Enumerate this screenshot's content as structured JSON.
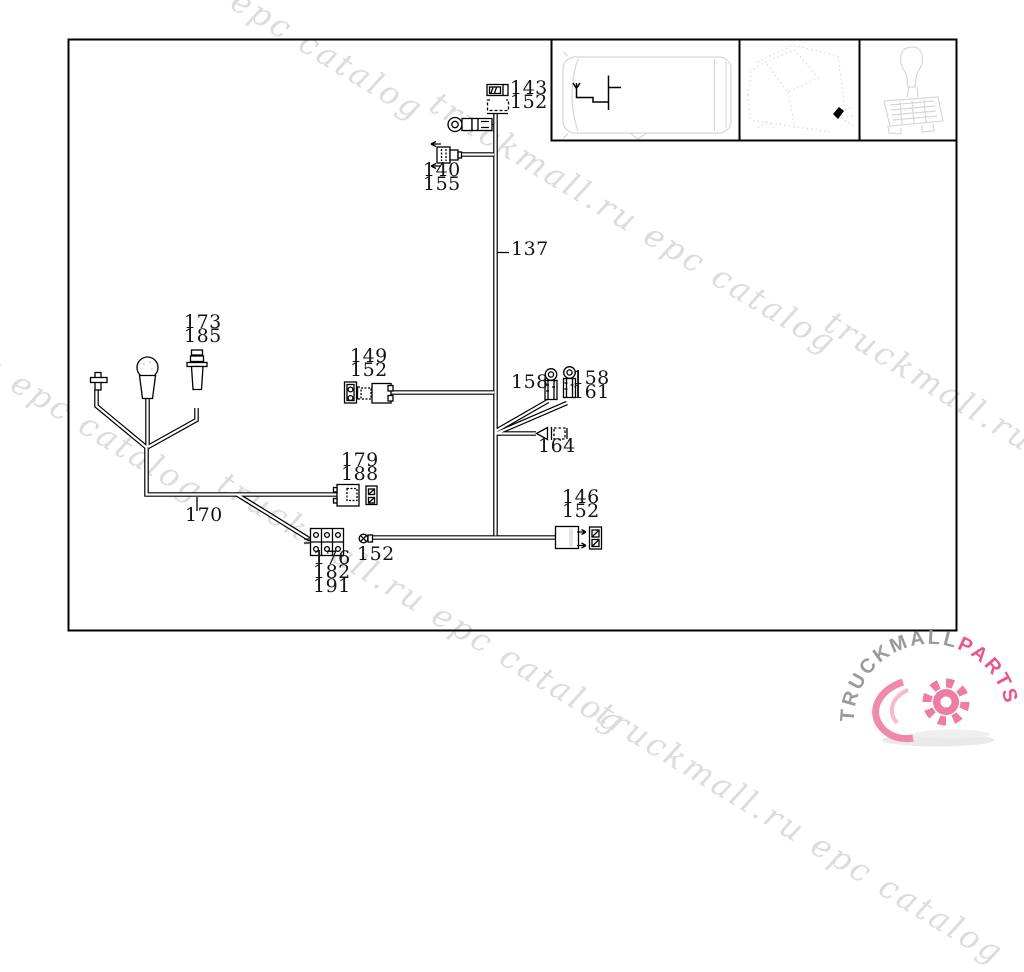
{
  "watermark": {
    "text": "truckmall.ru epc catalog",
    "color": "#dcdcdc"
  },
  "diagram": {
    "type": "wiring-harness-parts-diagram",
    "line_color": "#000000",
    "thumbnail_sketch_color": "#d7d7d7",
    "labels": [
      {
        "text": "143",
        "x": 510,
        "y": 79
      },
      {
        "text": "152",
        "x": 510,
        "y": 93
      },
      {
        "text": "140",
        "x": 423,
        "y": 161
      },
      {
        "text": "155",
        "x": 423,
        "y": 175
      },
      {
        "text": "137",
        "x": 511,
        "y": 240
      },
      {
        "text": "173",
        "x": 184,
        "y": 313
      },
      {
        "text": "185",
        "x": 184,
        "y": 327
      },
      {
        "text": "149",
        "x": 350,
        "y": 347
      },
      {
        "text": "152",
        "x": 350,
        "y": 361
      },
      {
        "text": "158",
        "x": 511,
        "y": 373
      },
      {
        "text": "158",
        "x": 572,
        "y": 369
      },
      {
        "text": "161",
        "x": 572,
        "y": 383
      },
      {
        "text": "164",
        "x": 538,
        "y": 437
      },
      {
        "text": "179",
        "x": 341,
        "y": 451
      },
      {
        "text": "188",
        "x": 341,
        "y": 465
      },
      {
        "text": "170",
        "x": 185,
        "y": 506
      },
      {
        "text": "146",
        "x": 562,
        "y": 488
      },
      {
        "text": "152",
        "x": 562,
        "y": 502
      },
      {
        "text": "152",
        "x": 357,
        "y": 545
      },
      {
        "text": "176",
        "x": 313,
        "y": 549
      },
      {
        "text": "182",
        "x": 313,
        "y": 563
      },
      {
        "text": "191",
        "x": 313,
        "y": 577
      }
    ]
  },
  "thumbnails": {
    "items": [
      {
        "name": "van-top-view-harness-location"
      },
      {
        "name": "van-cab-view-harness-location"
      },
      {
        "name": "gear-shift-lever"
      }
    ]
  },
  "logo": {
    "text_primary": "TRUCKMALL",
    "text_accent": "PARTS",
    "primary_color": "#9a9a9a",
    "accent_color": "#ee5586",
    "gear_color": "#ef7ca2"
  }
}
